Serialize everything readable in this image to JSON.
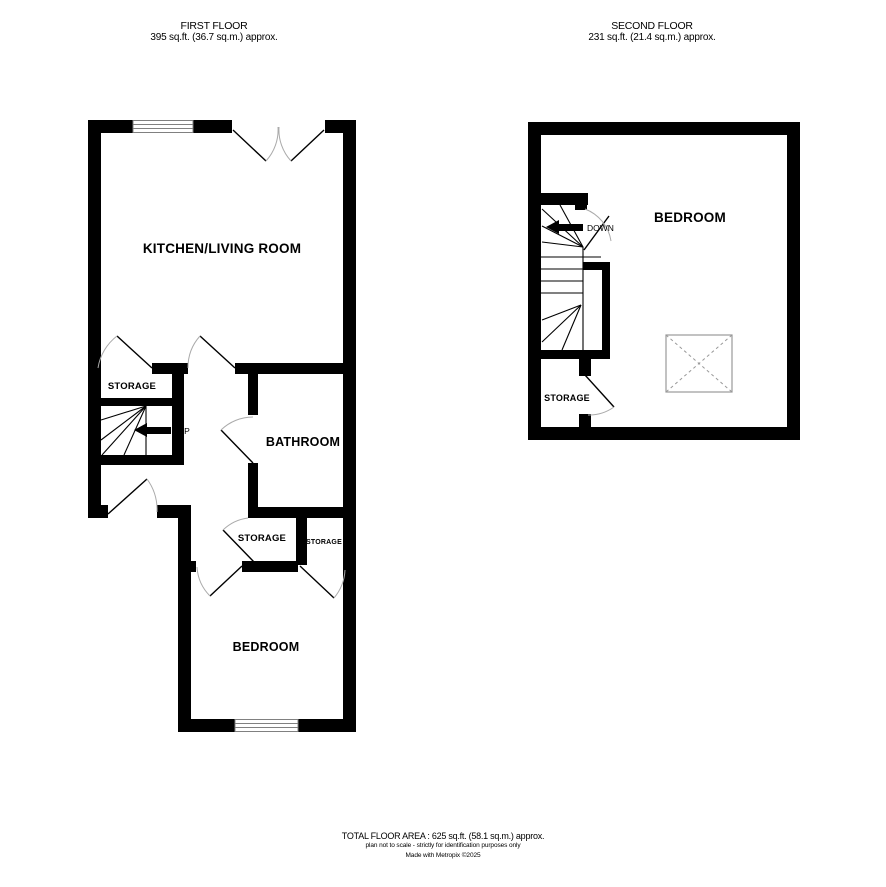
{
  "first_floor": {
    "title": "FIRST FLOOR",
    "area_label": "395 sq.ft. (36.7 sq.m.) approx.",
    "rooms": {
      "kitchen_living_room": "KITCHEN/LIVING ROOM",
      "hall_storage": "STORAGE",
      "bathroom": "BATHROOM",
      "storage_left": "STORAGE",
      "storage_right": "STORAGE",
      "bedroom": "BEDROOM"
    },
    "stairs_direction": "UP"
  },
  "second_floor": {
    "title": "SECOND FLOOR",
    "area_label": "231 sq.ft. (21.4 sq.m.) approx.",
    "rooms": {
      "bedroom": "BEDROOM",
      "storage": "STORAGE"
    },
    "stairs_direction": "DOWN"
  },
  "footer": {
    "total_area": "TOTAL FLOOR AREA : 625 sq.ft. (58.1 sq.m.) approx.",
    "disclaimer": "plan not to scale - strictly for identification purposes only",
    "credit": "Made with Metropix ©2025"
  },
  "colors": {
    "wall": "#000000",
    "door_arc": "#aaaaaa",
    "fixture_outline": "#999999",
    "text": "#000000"
  }
}
